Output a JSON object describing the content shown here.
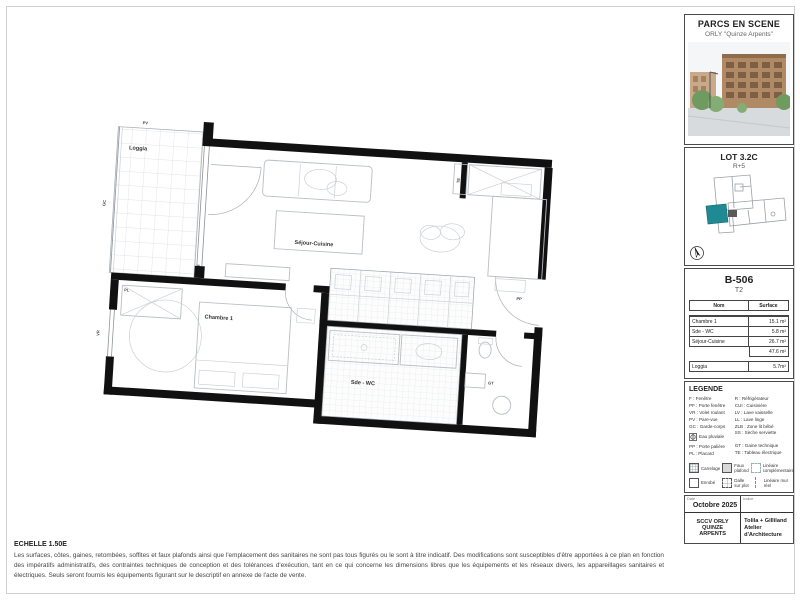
{
  "document": {
    "scale_label": "ECHELLE 1.50E",
    "disclaimer": "Les surfaces, côtes, gaines, retombées, soffites et faux plafonds ainsi que l'emplacement des sanitaires ne sont pas tous figurés ou le sont à titre indicatif. Des modifications sont susceptibles d'être apportées à ce plan en fonction des impératifs administratifs, des contraintes techniques de conception et des tolérances d'exécution, tant en ce qui concerne les dimensions libres que les équipements et les réseaux divers, les appareillages sanitaires et électriques. Seuls seront fournis les équipements figurant sur le descriptif en annexe de l'acte de vente."
  },
  "plan": {
    "rooms": {
      "loggia": "Loggia",
      "sejour": "Séjour-Cuisine",
      "chambre": "Chambre 1",
      "sde": "Sde - WC"
    },
    "tags": {
      "pv": "PV",
      "gc": "GC",
      "vr": "VR",
      "pp": "PP",
      "gt": "GT",
      "te": "TE",
      "pl": "PL"
    }
  },
  "sidebar": {
    "header": {
      "title": "PARCS EN SCENE",
      "subtitle": "ORLY \"Quinze Arpents\""
    },
    "lot": {
      "title": "LOT 3.2C",
      "level": "R+5"
    },
    "unit": {
      "id": "B-506",
      "type": "T2",
      "table": {
        "headers": [
          "Nom",
          "Surface"
        ],
        "rows": [
          [
            "Chambre 1",
            "15.1 m²"
          ],
          [
            "Sde - WC",
            "5.8 m²"
          ],
          [
            "Séjour-Cuisine",
            "26.7 m²"
          ]
        ],
        "total": "47.6 m²",
        "loggia_row": [
          "Loggia",
          "5.7m²"
        ]
      }
    },
    "legend": {
      "title": "LEGENDE",
      "col1": [
        "F : Fenêtre",
        "PF : Porte fenêtre",
        "VR : Volet roulant",
        "PV : Pare-vue",
        "GC : Garde-corps"
      ],
      "ep": {
        "label": "Eau pluviale"
      },
      "col1b": [
        "PP : Porte palière",
        "PL : Placard"
      ],
      "col2": [
        "R : Réfrigérateur",
        "CUI : Cuisinière",
        "LV : Lave vaisselle",
        "LL : Lave linge",
        "ZLB : Zone lit bébé",
        "SS : Sèche serviette"
      ],
      "col2b": [
        "GT : Gaine technique",
        "TE : Tableau électrique"
      ],
      "swatches": [
        {
          "label": "Carrelage"
        },
        {
          "label": "Faux plafond"
        },
        {
          "label": "Linéaire complémentaire"
        },
        {
          "label": "Enrobé"
        },
        {
          "label": "Dalle sur plot"
        },
        {
          "label": "Linéaire mur réel"
        }
      ]
    },
    "titleblock": {
      "date_label": "Date",
      "date": "Octobre 2025",
      "indice_label": "Indice",
      "client": "SCCV ORLY QUINZE ARPENTS",
      "architect": "Tolila + Gilliland Atelier d'Architecture"
    }
  },
  "colors": {
    "highlight": "#1f8a93",
    "wall": "#111111"
  }
}
